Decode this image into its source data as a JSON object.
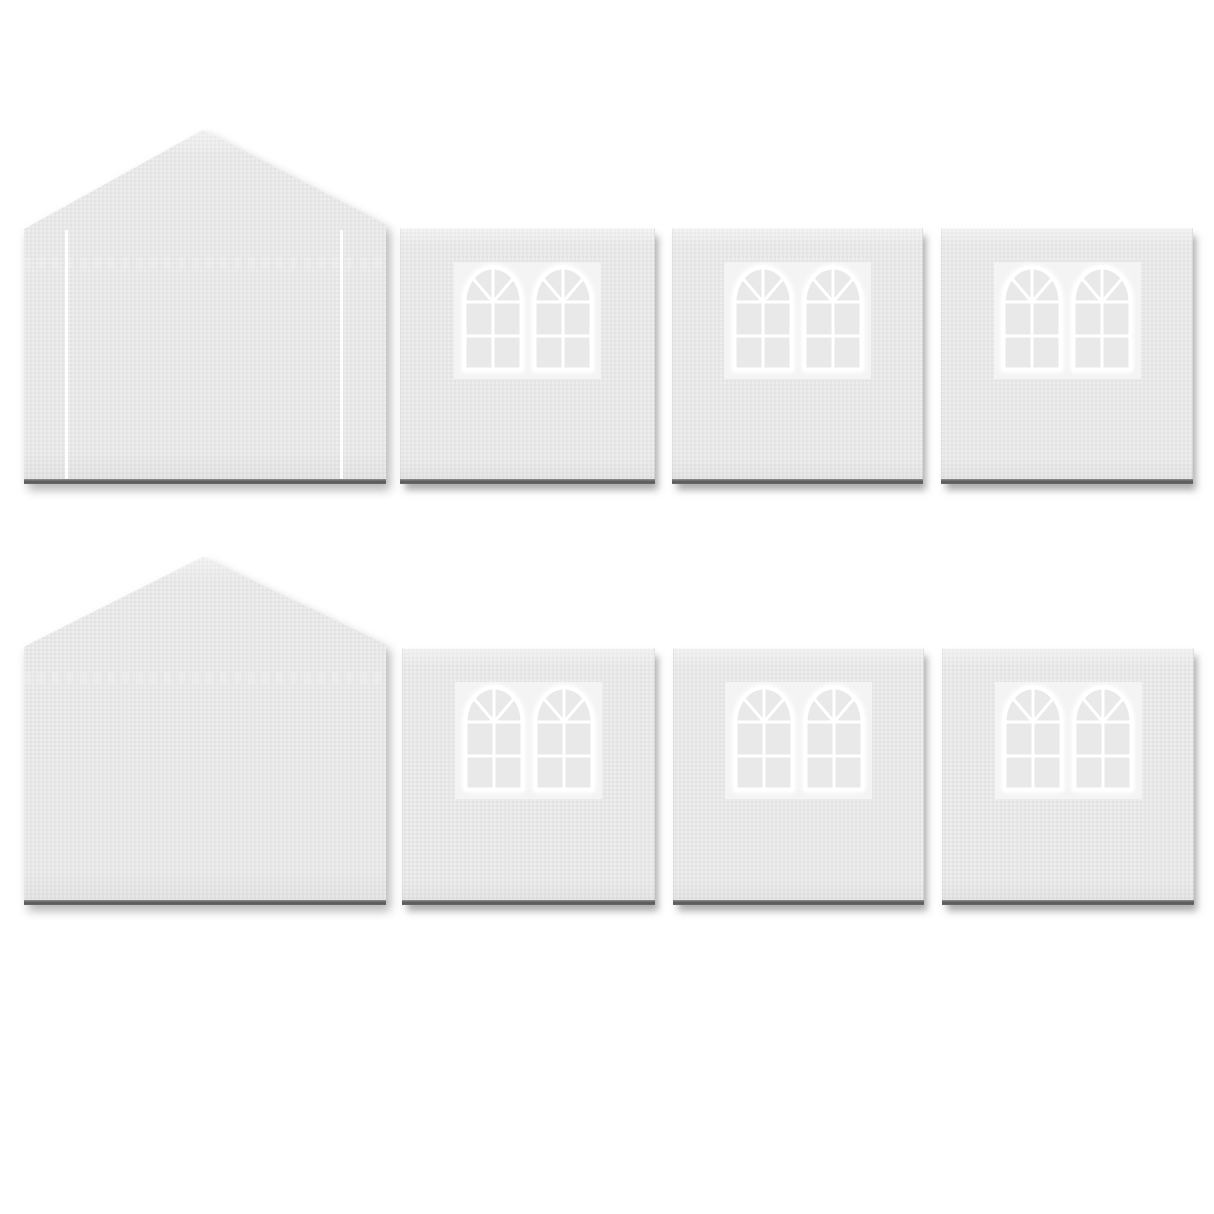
{
  "meta": {
    "description": "Product image: eight-piece white canopy tent sidewall set on a plain white background, no text",
    "background_color": "#ffffff"
  },
  "palette": {
    "panel_fill": "#ececec",
    "panel_highlight": "#f2f2f2",
    "window_backdrop": "#f4f4f4",
    "window_pane": "#e9e9e9",
    "window_frame": "#ffffff",
    "door_line": "#ffffff",
    "bottom_edge_dark": "#585858",
    "drop_shadow": "rgba(90,90,90,0.5)"
  },
  "icons": {
    "arched_window": "arched-window-icon: double-hung arch window with fan-light top (1 vertical + 2 diagonal spokes) over a 2x2 pane grid, white frame"
  },
  "grid": {
    "rows": [
      {
        "name": "top-row",
        "panels": [
          {
            "title": "Gable end wall panel with two vertical door zipper lines",
            "type": "gable",
            "door_lines": 2,
            "windows": 0
          },
          {
            "title": "Side wall panel with two arched windows",
            "type": "window-wall",
            "door_lines": 0,
            "windows": 2
          },
          {
            "title": "Side wall panel with two arched windows",
            "type": "window-wall",
            "door_lines": 0,
            "windows": 2
          },
          {
            "title": "Side wall panel with two arched windows",
            "type": "window-wall",
            "door_lines": 0,
            "windows": 2
          }
        ]
      },
      {
        "name": "bottom-row",
        "panels": [
          {
            "title": "Plain gable end wall panel",
            "type": "gable",
            "door_lines": 0,
            "windows": 0
          },
          {
            "title": "Side wall panel with two arched windows",
            "type": "window-wall",
            "door_lines": 0,
            "windows": 2
          },
          {
            "title": "Side wall panel with two arched windows",
            "type": "window-wall",
            "door_lines": 0,
            "windows": 2
          },
          {
            "title": "Side wall panel with two arched windows",
            "type": "window-wall",
            "door_lines": 0,
            "windows": 2
          }
        ]
      }
    ]
  }
}
